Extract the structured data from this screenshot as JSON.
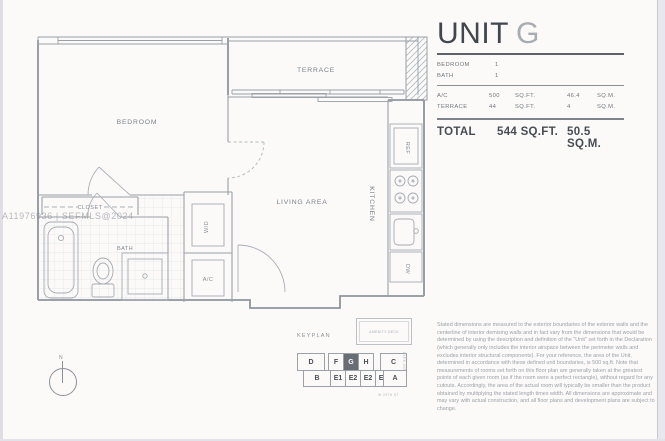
{
  "floor_plan": {
    "rooms": {
      "bedroom": "BEDROOM",
      "terrace": "TERRACE",
      "closet": "CLOSET",
      "bath": "BATH",
      "living": "LIVING AREA",
      "kitchen": "KITCHEN",
      "washer_dryer": "W/D",
      "ac_closet": "A/C",
      "refrigerator": "REF",
      "dishwasher": "DW"
    },
    "watermark": "A11976936 | SEFMLS@2024",
    "compass_label": "N"
  },
  "keyplan": {
    "title": "KEYPLAN",
    "note_box": "AMENITY DECK",
    "street_right": "PARK AVE",
    "street_bottom": "W 29TH ST",
    "top_row": [
      "D",
      "F",
      "G",
      "H",
      "C"
    ],
    "bottom_row": [
      "B",
      "E1",
      "E2",
      "E2",
      "E1",
      "A"
    ],
    "highlighted_unit": "G",
    "highlight_color": "#686d74"
  },
  "unit_panel": {
    "title_main": "UNIT",
    "title_letter": "G",
    "rooms": [
      {
        "label": "BEDROOM",
        "value": "1"
      },
      {
        "label": "BATH",
        "value": "1"
      }
    ],
    "areas": [
      {
        "label": "A/C",
        "sqft": "500",
        "sqft_unit": "SQ.FT.",
        "sqm": "46.4",
        "sqm_unit": "SQ.M."
      },
      {
        "label": "TERRACE",
        "sqft": "44",
        "sqft_unit": "SQ.FT.",
        "sqm": "4",
        "sqm_unit": "SQ.M."
      }
    ],
    "total": {
      "label": "TOTAL",
      "sqft": "544 SQ.FT.",
      "sqm": "50.5 SQ.M."
    },
    "disclaimer": "Stated dimensions are measured to the exterior boundaries of the exterior walls and the centerline of interior demising walls and in fact vary from the dimensions that would be determined by using the description and definition of the \"Unit\" set forth in the Declaration (which generally only includes the interior airspace between the perimeter walls and excludes interior structural components).  For your reference, the area of the Unit, determined in accordance with these defined unit boundaries, is 500 sq.ft. Note that measurements of rooms set forth on this floor plan are generally taken at the greatest points of each given room (as if the room were a perfect rectangle), without regard for any cutouts.  Accordingly, the area of the actual room will typically be smaller than the product obtained by multiplying the stated length times width.  All dimensions are approximate and may vary with actual construction, and all floor plans and development plans are subject to change."
  }
}
